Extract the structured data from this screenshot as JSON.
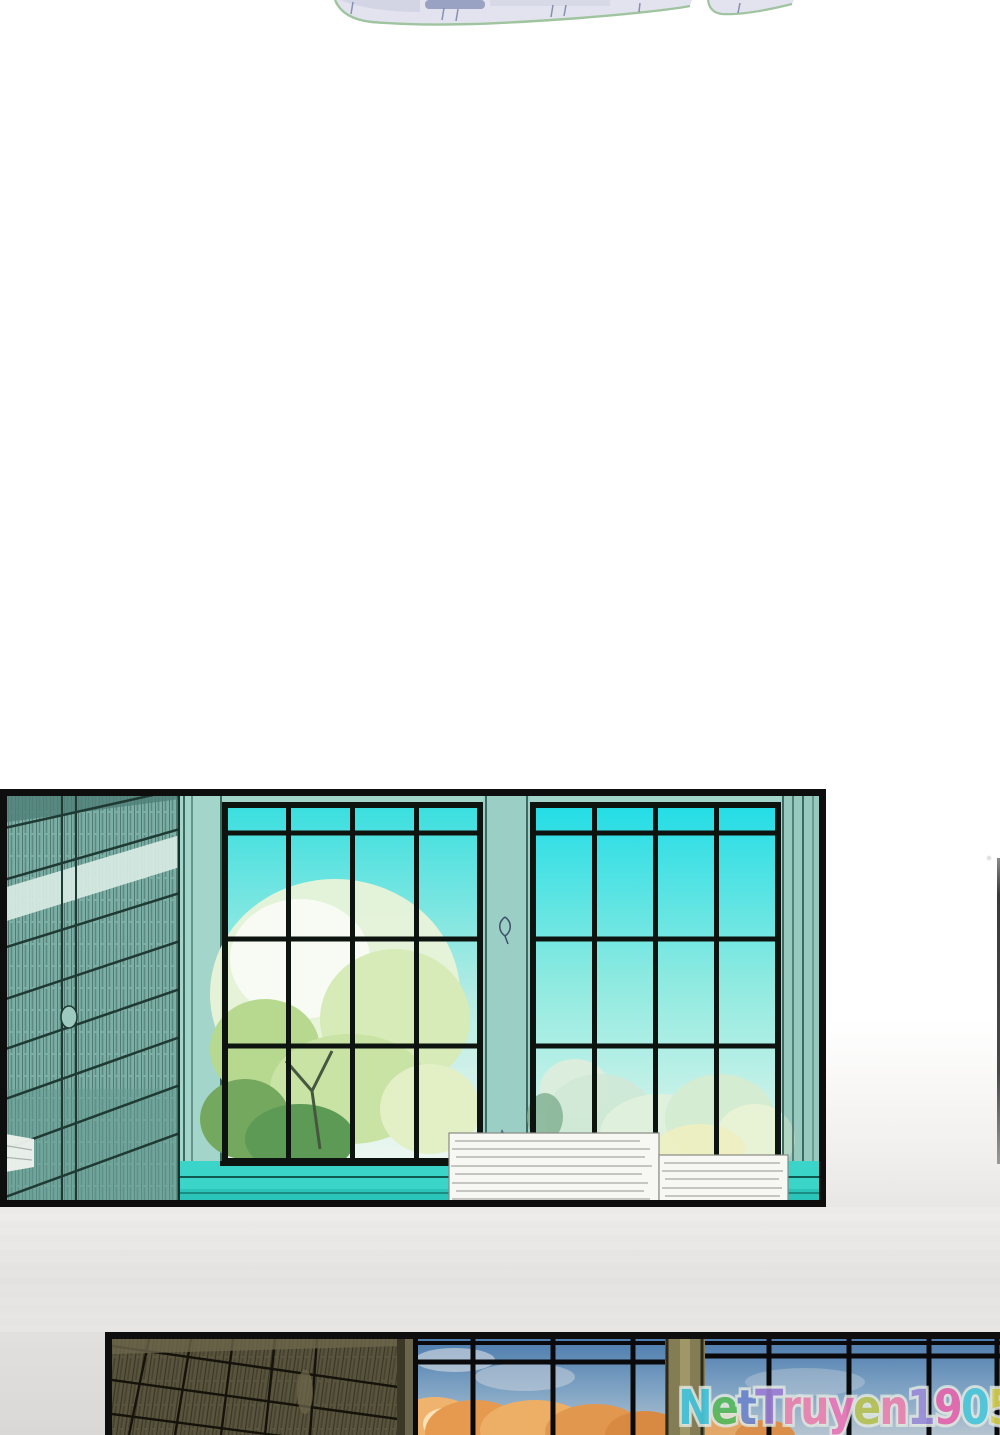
{
  "watermark": {
    "text": "NetTruyen1905",
    "outline_color": "#dde4dd",
    "letters": [
      {
        "ch": "N",
        "color": "#45c4da"
      },
      {
        "ch": "e",
        "color": "#58b95e"
      },
      {
        "ch": "t",
        "color": "#6d87cc"
      },
      {
        "ch": "T",
        "color": "#9b7ed4"
      },
      {
        "ch": "r",
        "color": "#ea85b0"
      },
      {
        "ch": "u",
        "color": "#ea85b0"
      },
      {
        "ch": "y",
        "color": "#e878b8"
      },
      {
        "ch": "e",
        "color": "#b8c257"
      },
      {
        "ch": "n",
        "color": "#ea85b0"
      },
      {
        "ch": "1",
        "color": "#9c8ed8"
      },
      {
        "ch": "9",
        "color": "#e468ae"
      },
      {
        "ch": "0",
        "color": "#4ec7da"
      },
      {
        "ch": "5",
        "color": "#d6d052"
      }
    ]
  },
  "palette": {
    "panel_border": "#0e0e0e",
    "day_sky_cyan": "#25dee6",
    "library_shelf_teal": "#7cb0a7",
    "window_frame_teal": "#a4d5ca",
    "sill_turquoise": "#3bd4c8",
    "book_stack_white": "#f7f7f4",
    "dusk_sky_blue": "#4c7cae",
    "dusk_foliage_orange": "#e59a50",
    "dusk_shelf_olive": "#59543e",
    "gap_gray": "#e6e4e2",
    "fragment_lavender": "#e2e3ee",
    "fragment_outline_green": "#9fc49f"
  }
}
